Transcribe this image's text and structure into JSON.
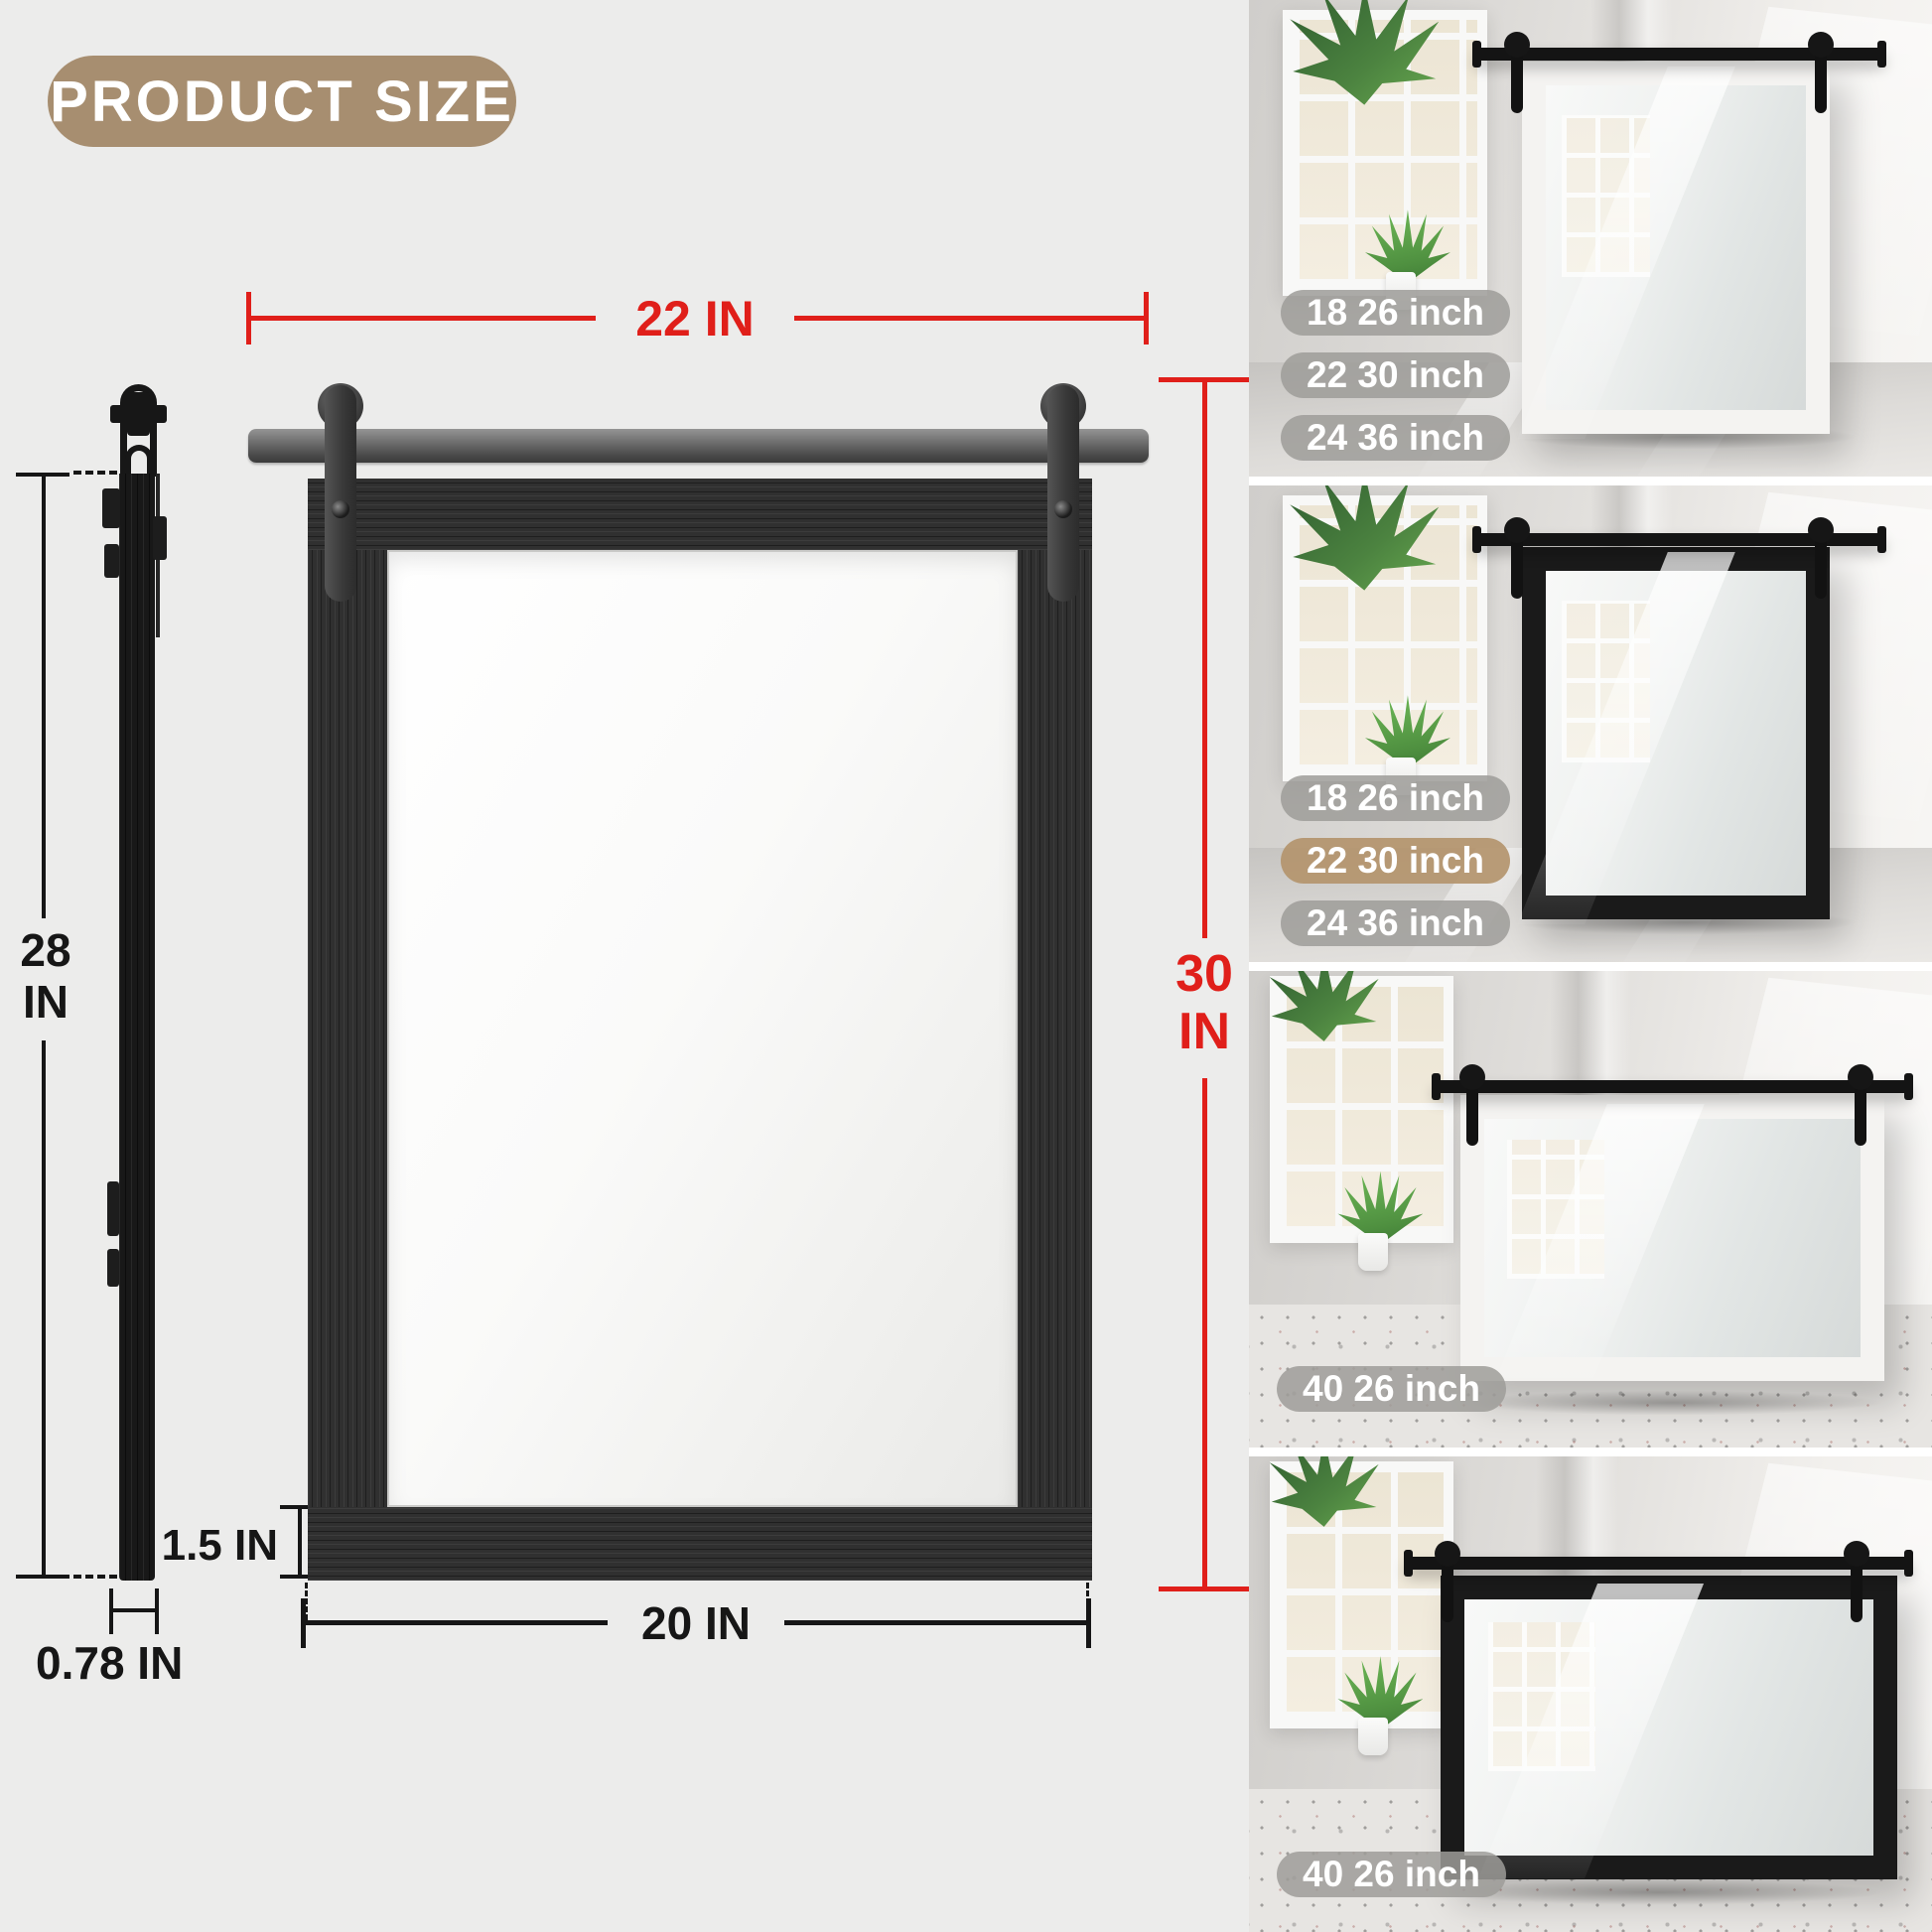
{
  "badge": {
    "label": "PRODUCT SIZE",
    "bg": "#a78e70"
  },
  "colors": {
    "accent_red": "#e01f1a",
    "dimension_black": "#161616",
    "background": "#ececeb",
    "pill_gray": "#9e9c99",
    "pill_selected_tan": "#b4946e"
  },
  "diagram": {
    "rail_width": "22 IN",
    "total_height_l1": "30",
    "total_height_l2": "IN",
    "inner_width": "16 IN",
    "inner_height_l1": "23.6",
    "inner_height_l2": "IN",
    "side_height_l1": "28",
    "side_height_l2": "IN",
    "frame_thickness": "1.5 IN",
    "bottom_width": "20 IN",
    "depth": "0.78 IN"
  },
  "photos": [
    {
      "frame_black": false,
      "landscape": false,
      "labels": [
        {
          "text": "18 26 inch",
          "selected": false
        },
        {
          "text": "22 30 inch",
          "selected": false
        },
        {
          "text": "24 36 inch",
          "selected": false
        }
      ]
    },
    {
      "frame_black": true,
      "landscape": false,
      "labels": [
        {
          "text": "18 26 inch",
          "selected": false
        },
        {
          "text": "22 30 inch",
          "selected": true
        },
        {
          "text": "24 36 inch",
          "selected": false
        }
      ]
    },
    {
      "frame_black": false,
      "landscape": true,
      "labels": [
        {
          "text": "40 26 inch",
          "selected": false
        }
      ]
    },
    {
      "frame_black": true,
      "landscape": true,
      "labels": [
        {
          "text": "40 26 inch",
          "selected": false
        }
      ]
    }
  ]
}
